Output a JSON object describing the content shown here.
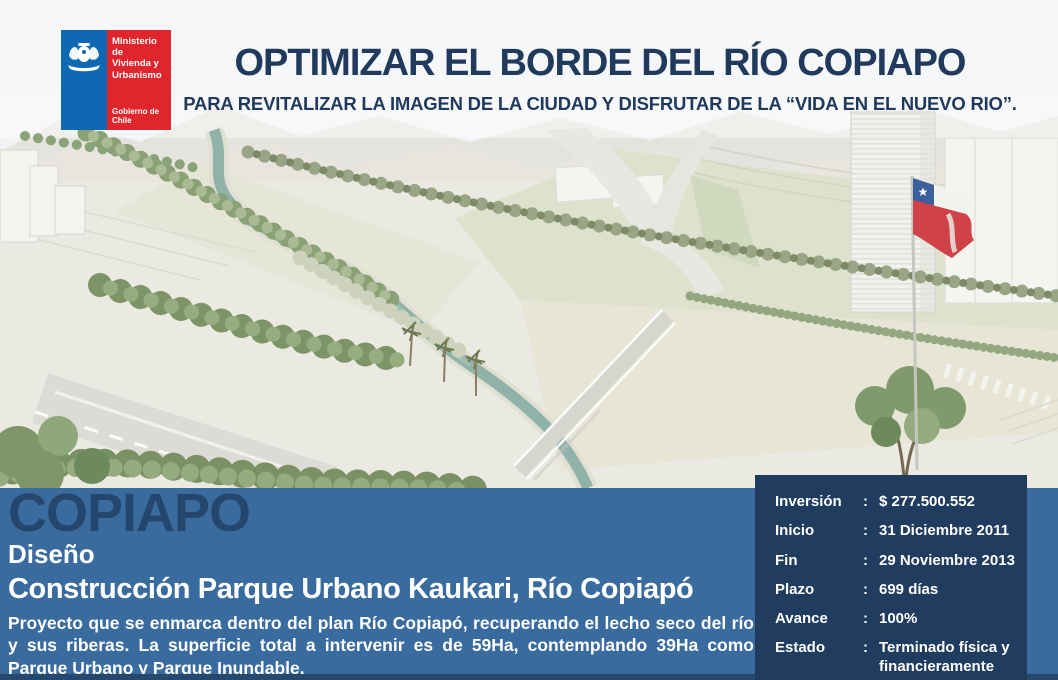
{
  "logo": {
    "ministry_lines": "Ministerio de\nVivienda y\nUrbanismo",
    "government": "Gobierno de Chile"
  },
  "header": {
    "title": "OPTIMIZAR EL BORDE DEL RÍO COPIAPO",
    "subtitle": "PARA REVITALIZAR LA IMAGEN DE LA CIUDAD Y DISFRUTAR DE LA “VIDA EN EL NUEVO RIO”."
  },
  "project": {
    "city": "COPIAPO",
    "stage": "Diseño",
    "title": "Construcción Parque Urbano Kaukari, Río Copiapó",
    "description": "Proyecto que se enmarca dentro del plan Río Copiapó, recuperando el lecho seco del río y sus riberas. La superficie total a intervenir es de 59Ha, contemplando 39Ha como Parque Urbano y Parque Inundable."
  },
  "details": {
    "separator": ":",
    "rows": [
      {
        "label": "Inversión",
        "value": "$ 277.500.552"
      },
      {
        "label": "Inicio",
        "value": "31 Diciembre 2011"
      },
      {
        "label": "Fin",
        "value": "29 Noviembre 2013"
      },
      {
        "label": "Plazo",
        "value": "699 días"
      },
      {
        "label": "Avance",
        "value": "100%"
      },
      {
        "label": "Estado",
        "value": "Terminado física y financieramente"
      }
    ]
  },
  "colors": {
    "title_navy": "#1F3A5C",
    "band_blue": "#3A6B9E",
    "box_navy": "#203C5E",
    "city_navy": "#26476D",
    "logo_blue": "#0F69B2",
    "logo_red": "#E0262C",
    "flag_red": "#CF4248",
    "flag_blue": "#3C5F9E",
    "river_teal": "#8CAFA6"
  }
}
